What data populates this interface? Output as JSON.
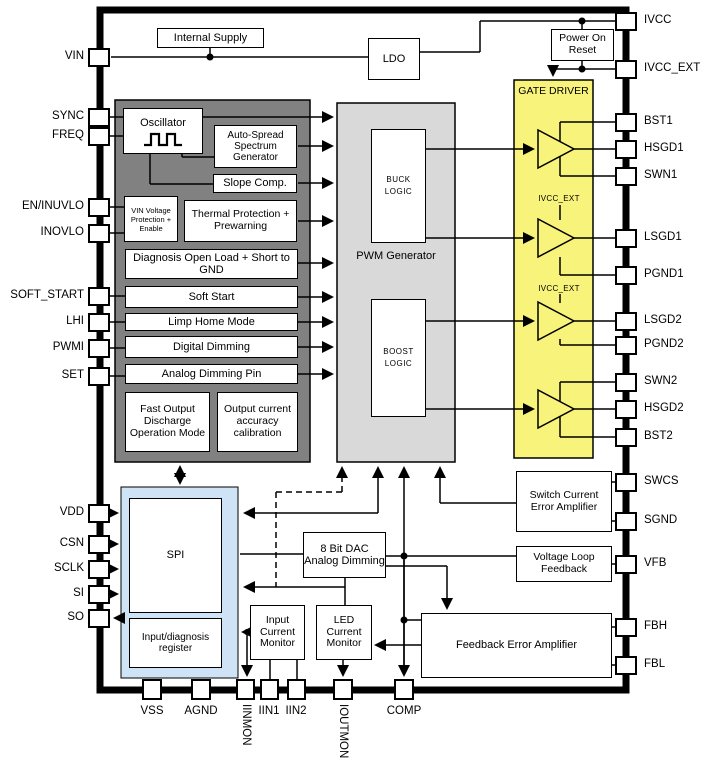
{
  "diagram_type": "ic-block-diagram",
  "colors": {
    "gate_driver_fill": "#f8f37b",
    "control_block_fill": "#818181",
    "pwm_block_fill": "#d9d9d9",
    "spi_block_fill": "#cfe3f6",
    "block_fill": "#ffffff",
    "line_color": "#000000"
  },
  "icons": {
    "oscillator_waveform": "square-wave"
  },
  "pins": {
    "left": [
      "VIN",
      "SYNC",
      "FREQ",
      "EN/INUVLO",
      "INOVLO",
      "SOFT_START",
      "LHI",
      "PWMI",
      "SET",
      "VDD",
      "CSN",
      "SCLK",
      "SI",
      "SO"
    ],
    "right": [
      "IVCC",
      "IVCC_EXT",
      "BST1",
      "HSGD1",
      "SWN1",
      "LSGD1",
      "PGND1",
      "LSGD2",
      "PGND2",
      "SWN2",
      "HSGD2",
      "BST2",
      "SWCS",
      "SGND",
      "VFB",
      "FBH",
      "FBL"
    ],
    "bottom": [
      "VSS",
      "AGND",
      "IINMON",
      "IIN1",
      "IIN2",
      "IOUTMON",
      "COMP"
    ]
  },
  "blocks": {
    "internal_supply": "Internal Supply",
    "ldo": "LDO",
    "power_on_reset": "Power On Reset",
    "gate_driver": "GATE DRIVER",
    "oscillator": "Oscillator",
    "auto_spread": "Auto-Spread Spectrum Generator",
    "slope_comp": "Slope Comp.",
    "vin_protection": "VIN Voltage Protection + Enable",
    "thermal": "Thermal Protection + Prewarning",
    "diagnosis": "Diagnosis Open Load + Short to GND",
    "soft_start": "Soft Start",
    "limp_home": "Limp Home Mode",
    "digital_dimming": "Digital Dimming",
    "analog_dimming": "Analog Dimming Pin",
    "fast_output_discharge": "Fast Output Discharge Operation Mode",
    "output_calibration": "Output current accuracy calibration",
    "pwm_generator": "PWM Generator",
    "buck_logic": "BUCK LOGIC",
    "boost_logic": "BOOST LOGIC",
    "spi": "SPI",
    "input_diagnosis_register": "Input/diagnosis register",
    "dac": "8 Bit DAC Analog Dimming",
    "input_current_monitor": "Input Current Monitor",
    "led_current_monitor": "LED Current Monitor",
    "feedback_error_amplifier": "Feedback Error Amplifier",
    "switch_current_error_amplifier": "Switch Current Error Amplifier",
    "voltage_loop_feedback": "Voltage Loop Feedback"
  },
  "net_labels": {
    "ivcc_ext": "IVCC_EXT"
  }
}
